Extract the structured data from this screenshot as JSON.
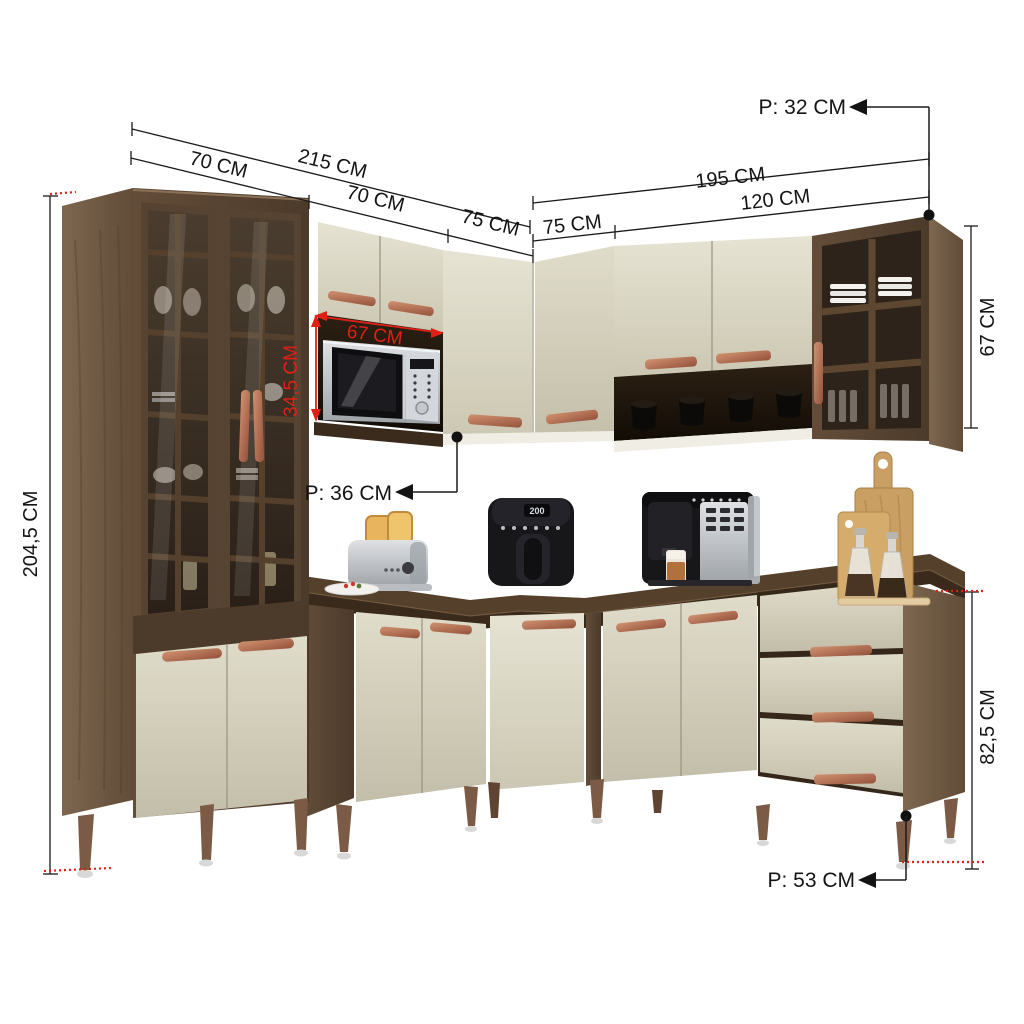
{
  "title": "Kitchen corner cabinet set with dimension annotations",
  "palette": {
    "background": "#ffffff",
    "wood_front": "#5e4936",
    "wood_side": "#77624b",
    "wood_counter": "#55402b",
    "cream_door": "#dcd8c6",
    "copper_handle": "#b97d5f",
    "dimension_line": "#1a1a1a",
    "dimension_red": "#e02015",
    "niche_interior": "#241a10"
  },
  "dimensions": {
    "left_total_height": "204,5 CM",
    "left_run_total_width": "215 CM",
    "left_run_segment_1": "70 CM",
    "left_run_segment_2": "70 CM",
    "left_run_segment_3": "75 CM",
    "right_run_total_width": "195 CM",
    "right_run_segment_1": "75 CM",
    "right_run_segment_2": "120 CM",
    "wall_cabinet_depth": "P: 32 CM",
    "wall_cabinet_height": "67 CM",
    "microwave_niche_width": "67 CM",
    "microwave_niche_height": "34,5 CM",
    "mid_wall_cabinet_depth": "P: 36 CM",
    "base_cabinet_height": "82,5 CM",
    "base_cabinet_depth": "P: 53 CM"
  },
  "appliances": {
    "air_fryer_display": "200"
  }
}
